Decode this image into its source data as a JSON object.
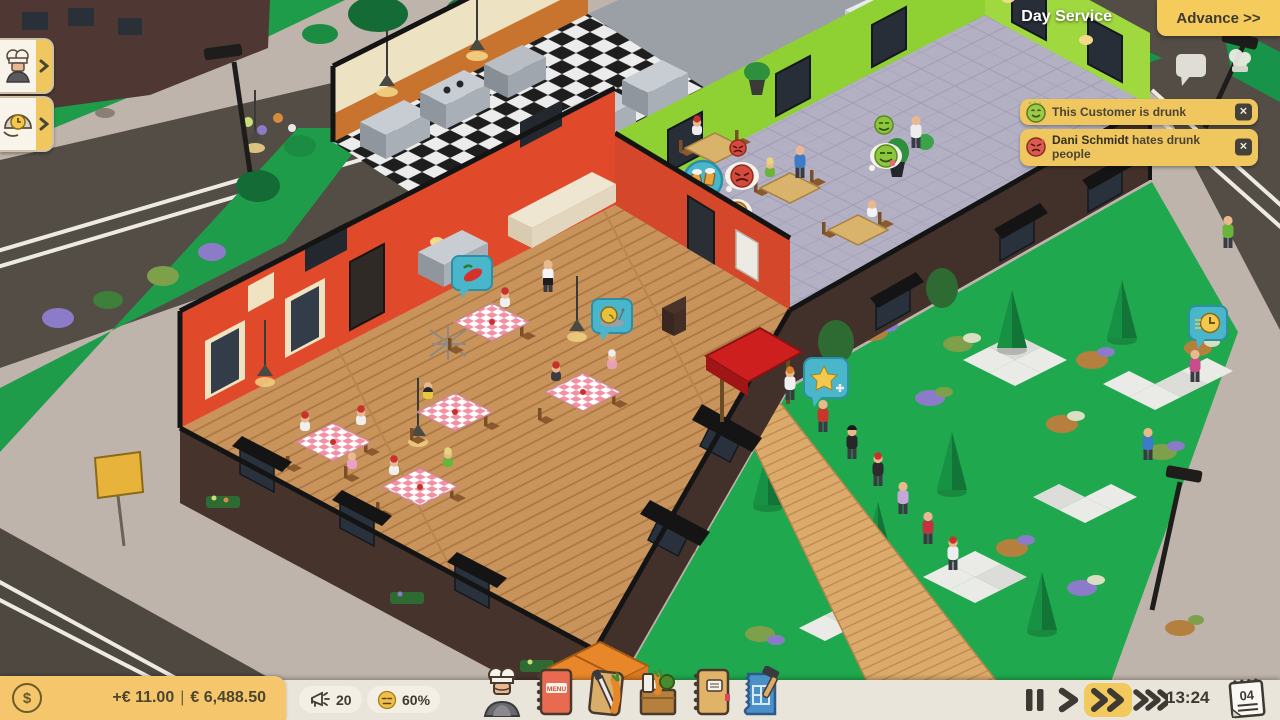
{
  "meta": {
    "app_context": "restaurant management game",
    "view": "restaurant overview"
  },
  "colors": {
    "hud_yellow": "#F5CB5C",
    "notification_yellow": "#EFC75E",
    "bar_cream": "#E9E5DB",
    "money_panel": "#F5C66B",
    "bubble_teal": "#49B6CB",
    "lawn_green": "#1FA84E",
    "dining_wall_red": "#E04A2B",
    "green_room_wall": "#8FD133",
    "brick_dark": "#42302A",
    "road_grey": "#534D46",
    "sidewalk": "#BEB4AB",
    "text_dark": "#3E3A32"
  },
  "hud": {
    "phase_label": "Day Service",
    "advance_label": "Advance >>",
    "left_panel_buttons": [
      {
        "name": "staff",
        "icon": "chef-icon"
      },
      {
        "name": "orders",
        "icon": "cloche-clock-icon"
      }
    ],
    "floating_icons": [
      {
        "icon": "chat-bubble-icon"
      },
      {
        "icon": "chef-hat-icon"
      }
    ],
    "notifications": [
      {
        "icon": "drunk-smiley-icon",
        "text": "This Customer is drunk",
        "close_label": "✕"
      },
      {
        "icon": "drunk-angry-icon",
        "name": "Dani Schmidt",
        "text": "hates drunk people",
        "close_label": "✕"
      }
    ],
    "bottom_bar": {
      "money": {
        "icon": "dollar-coin-icon",
        "coin_symbol": "$",
        "delta": "+€ 11.00",
        "separator": "|",
        "balance": "€ 6,488.50"
      },
      "stats": [
        {
          "name": "marketing",
          "icon": "megaphone-icon",
          "value": "20"
        },
        {
          "name": "satisfaction",
          "icon": "neutral-face-icon",
          "value": "60%"
        }
      ],
      "menu_buttons": [
        {
          "name": "staff",
          "icon": "chef-staff-icon"
        },
        {
          "name": "menu",
          "icon": "menu-book-icon",
          "label": "MENU"
        },
        {
          "name": "recipes",
          "icon": "cutting-board-knife-carrot-icon"
        },
        {
          "name": "ingredients",
          "icon": "vegetable-crate-icon"
        },
        {
          "name": "ledger",
          "icon": "notebook-icon"
        },
        {
          "name": "build",
          "icon": "blueprint-hammer-icon"
        }
      ],
      "time_controls": {
        "options": [
          "pause",
          "play",
          "fast",
          "fastest"
        ],
        "active": "fast"
      },
      "clock": "13:24",
      "day": "04"
    }
  },
  "scene": {
    "rooms": [
      "kitchen",
      "dining-room",
      "green-dining-room",
      "storage"
    ],
    "indicator_bubbles": [
      {
        "icon": "chili-pepper-bubble"
      },
      {
        "icon": "snail-bubble"
      },
      {
        "icon": "drinks-serving-indicator"
      },
      {
        "icon": "star-plus-bubble"
      },
      {
        "icon": "waiting-clock-bubble"
      },
      {
        "icon": "angry-emoji"
      },
      {
        "icon": "neutral-emoji"
      },
      {
        "icon": "happy-emoji"
      }
    ],
    "customer_queue_count": 7,
    "dining_tables_count": 5,
    "green_room_tables_count": 3
  }
}
